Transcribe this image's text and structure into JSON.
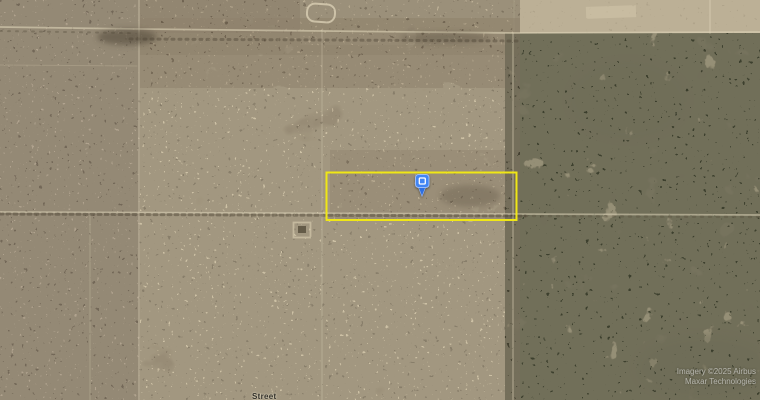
{
  "map": {
    "view": "satellite-imagery",
    "marker": {
      "icon": "placemark-pin",
      "glyph": "square-outline"
    },
    "parcel_overlay": "yellow-rectangle-boundary",
    "road_label": "Street",
    "attribution": {
      "line1": "Imagery ©2025 Airbus",
      "line2": "Maxar Technologies"
    },
    "colors": {
      "terrain_base": "#a59781",
      "terrain_left": "#9e9080",
      "terrain_mid": "#aa9c85",
      "terrain_right": "#b1a58c",
      "terrain_light": "#d3c7ab",
      "terrain_brown": "#8a7963",
      "vegetation_dark": "#383a29",
      "vegetation_mid": "#5b5c45",
      "road_light": "#ddd3b8",
      "road_dark": "#4a4131",
      "parcel_yellow": "#f0e715",
      "marker_blue": "#4285f4",
      "marker_blue_dark": "#2f6fe0",
      "marker_border": "#9bbdf9"
    }
  }
}
